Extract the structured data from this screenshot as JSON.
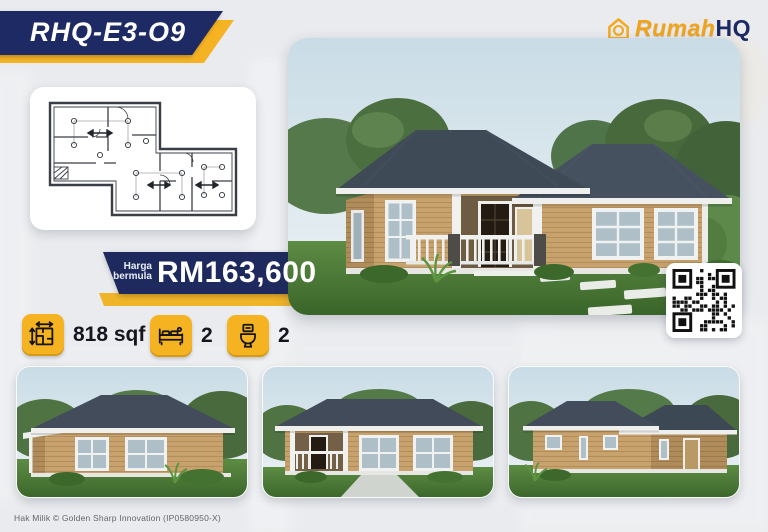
{
  "badge": {
    "code": "RHQ-E3-O9"
  },
  "logo": {
    "brand_primary": "Rumah",
    "brand_secondary": "HQ",
    "icon": "house-logo-icon"
  },
  "price": {
    "label_top": "Harga",
    "label_bottom": "bermula",
    "value": "RM163,600"
  },
  "specs": {
    "area": {
      "icon": "floor-area-icon",
      "label": "818 sqf"
    },
    "bedrooms": {
      "icon": "bed-icon",
      "count": "2"
    },
    "bathrooms": {
      "icon": "toilet-icon",
      "count": "2"
    }
  },
  "images": {
    "floor_plan": "floor-plan-drawing",
    "main_render": "house-exterior-front-perspective",
    "gallery": [
      "house-side-view",
      "house-front-view",
      "house-rear-view"
    ],
    "qr_code": "qr-code"
  },
  "footer": {
    "copyright": "Hak Milik © Golden Sharp Innovation (IP0580950-X)"
  },
  "colors": {
    "navy": "#1e2a63",
    "yellow": "#f5b324",
    "wall_tan": "#c7a26c",
    "roof_slate": "#414b5a",
    "background": "#e9ebee"
  }
}
